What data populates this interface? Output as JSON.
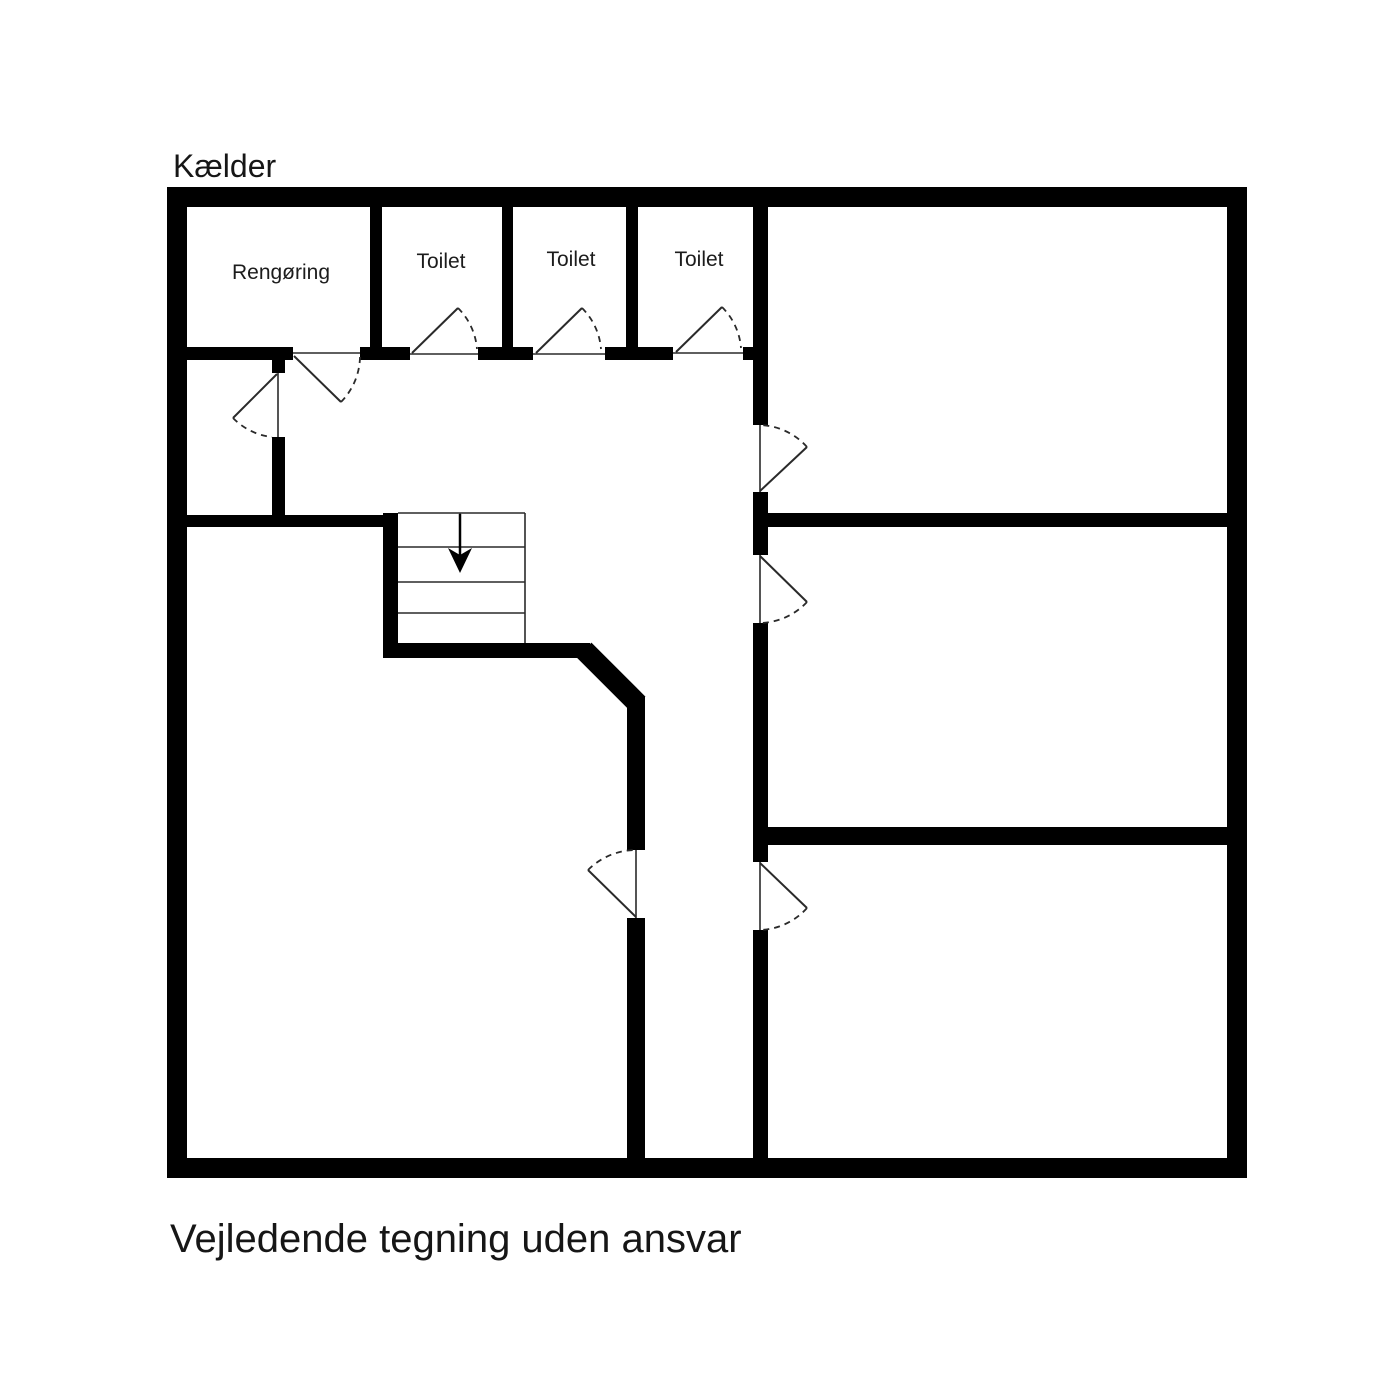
{
  "title": "Kælder",
  "disclaimer": "Vejledende tegning uden ansvar",
  "floor": {
    "level_name": "Kælder",
    "rooms": [
      {
        "id": "rengoring",
        "label": "Rengøring"
      },
      {
        "id": "toilet-1",
        "label": "Toilet"
      },
      {
        "id": "toilet-2",
        "label": "Toilet"
      },
      {
        "id": "toilet-3",
        "label": "Toilet"
      }
    ],
    "unlabeled_room_count": 5,
    "stairs": {
      "icon": "down-arrow-icon",
      "direction": "down",
      "treads": 4
    },
    "door_count": 9
  },
  "colors": {
    "wall": "#000000",
    "background": "#ffffff",
    "text": "#1c1c1c",
    "line": "#2a2a2a"
  }
}
